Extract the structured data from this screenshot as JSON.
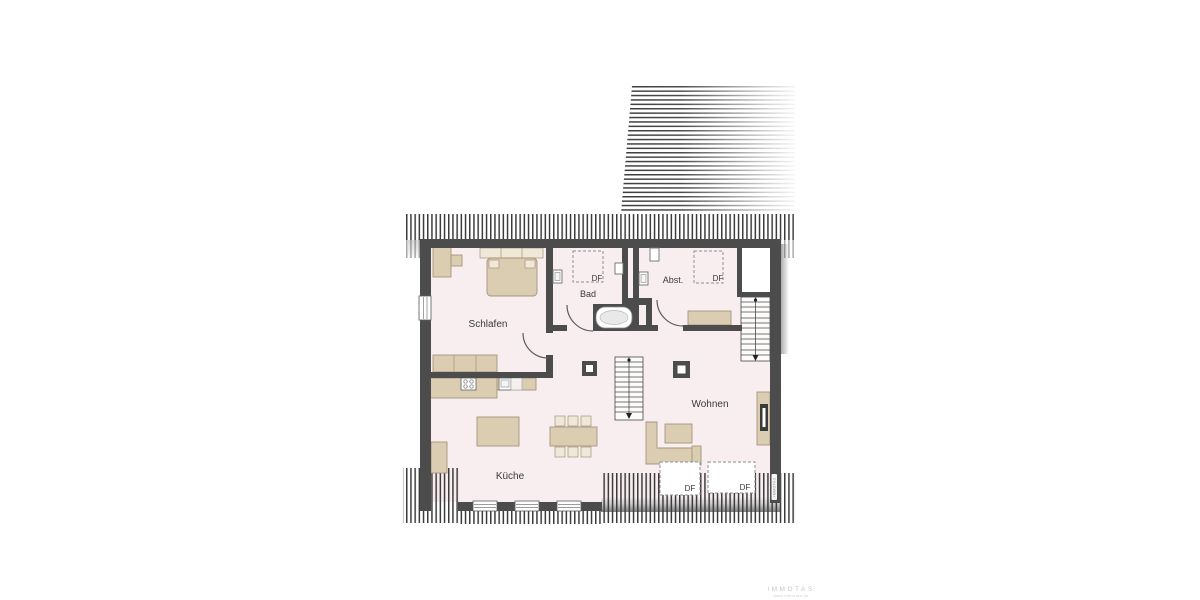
{
  "plan": {
    "title": "Dachgeschoss Grundriss",
    "rooms": {
      "bedroom": {
        "label": "Schlafen"
      },
      "bathroom": {
        "label": "Bad"
      },
      "storage": {
        "label": "Abst."
      },
      "living": {
        "label": "Wohnen"
      },
      "kitchen": {
        "label": "Küche"
      }
    },
    "skylight_label": "DF",
    "colors": {
      "wall": "#4c4c4c",
      "floor": "#f8eef0",
      "furniture": "#dbcdb2",
      "furniture_light": "#efe7d7",
      "furniture_stroke": "#a5947a",
      "hatch": "#3c3c3c",
      "dashed": "#8f8f8f",
      "text": "#3a3a3a",
      "watermark": "#c6c6c6"
    }
  },
  "watermark": {
    "brand": "IMMOTAS",
    "website": "www.immotas.de",
    "wall_text": "IMMOTAS"
  }
}
